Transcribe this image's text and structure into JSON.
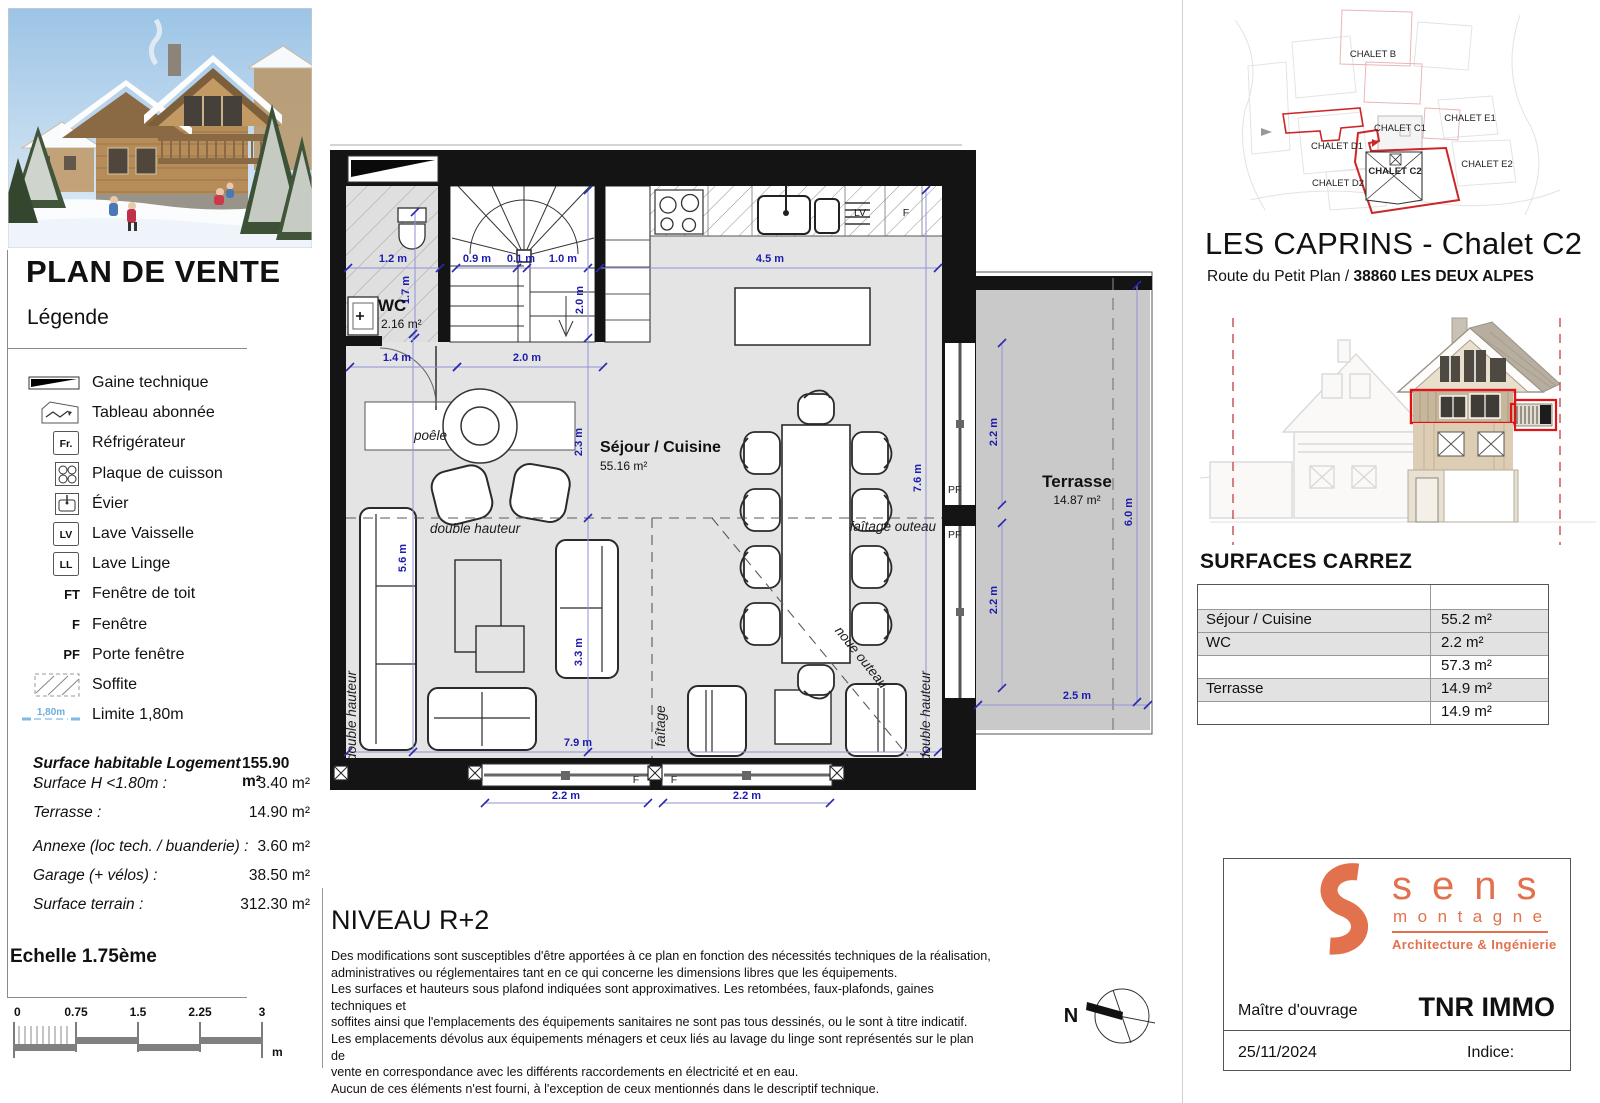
{
  "left_panel": {
    "title": "PLAN DE VENTE",
    "legend_title": "Légende",
    "legend_items": [
      {
        "type": "gaine",
        "label": "Gaine technique"
      },
      {
        "type": "tableau",
        "label": "Tableau abonnée"
      },
      {
        "type": "boxtext",
        "symbol": "Fr.",
        "label": "Réfrigérateur"
      },
      {
        "type": "plaque",
        "label": "Plaque de cuisson"
      },
      {
        "type": "evier",
        "label": "Évier"
      },
      {
        "type": "boxtext",
        "symbol": "LV",
        "label": "Lave Vaisselle"
      },
      {
        "type": "boxtext",
        "symbol": "LL",
        "label": "Lave Linge"
      },
      {
        "type": "text",
        "symbol": "FT",
        "label": "Fenêtre de toit"
      },
      {
        "type": "text",
        "symbol": "F",
        "label": "Fenêtre"
      },
      {
        "type": "text",
        "symbol": "PF",
        "label": "Porte fenêtre"
      },
      {
        "type": "soffite",
        "label": "Soffite"
      },
      {
        "type": "limite",
        "symbol": "1,80m",
        "label": "Limite 1,80m"
      }
    ],
    "surfaces": [
      {
        "label": "Surface habitable Logement :",
        "value": "155.90 m²",
        "bold": true,
        "top": 755
      },
      {
        "label": "Surface H <1.80m :",
        "value": "3.40 m²",
        "bold": false,
        "top": 775
      },
      {
        "label": "Terrasse :",
        "value": "14.90 m²",
        "bold": false,
        "top": 804
      },
      {
        "label": "Annexe (loc tech. / buanderie) :",
        "value": "3.60 m²",
        "bold": false,
        "top": 838
      },
      {
        "label": "Garage (+ vélos) :",
        "value": "38.50 m²",
        "bold": false,
        "top": 867
      },
      {
        "label": "Surface terrain :",
        "value": "312.30 m²",
        "bold": false,
        "top": 896
      }
    ],
    "scale_title": "Echelle 1.75ème",
    "scale_ticks": [
      "0",
      "0.75",
      "1.5",
      "2.25",
      "3"
    ],
    "scale_unit": "m"
  },
  "plan": {
    "level_title": "NIVEAU R+2",
    "disclaimer_lines": [
      "Des modifications sont susceptibles d'être apportées à ce plan en fonction des nécessités techniques de la réalisation,",
      "administratives ou réglementaires tant en ce qui concerne les dimensions libres que les équipements.",
      "Les surfaces et hauteurs sous plafond indiquées sont approximatives. Les retombées, faux-plafonds, gaines techniques et",
      "soffites ainsi que l'emplacements des équipements sanitaires ne sont pas tous dessinés, ou le sont à titre indicatif.",
      "Les emplacements dévolus aux équipements ménagers et ceux liés au lavage du linge sont représentés sur le plan de",
      "vente en correspondance avec les différents raccordements en électricité et en eau.",
      "Aucun de ces éléments n'est fourni, à l'exception de ceux mentionnés dans le descriptif technique."
    ],
    "compass_label": "N",
    "rooms": [
      {
        "name": "WC",
        "area": "2.16 m²",
        "nx": 378,
        "ny": 311,
        "ax": 381,
        "ay": 328,
        "ns": 17,
        "anchor": "start"
      },
      {
        "name": "Séjour / Cuisine",
        "area": "55.16 m²",
        "nx": 600,
        "ny": 452,
        "ax": 600,
        "ay": 470,
        "ns": 16,
        "anchor": "start"
      },
      {
        "name": "Terrasse",
        "area": "14.87 m²",
        "nx": 1077,
        "ny": 487,
        "ax": 1077,
        "ay": 504,
        "ns": 17,
        "anchor": "middle"
      }
    ],
    "dim_labels": [
      {
        "t": "1.2 m",
        "x": 393,
        "y": 262
      },
      {
        "t": "0.9 m",
        "x": 477,
        "y": 262
      },
      {
        "t": "0.1 m",
        "x": 521,
        "y": 262
      },
      {
        "t": "1.0 m",
        "x": 563,
        "y": 262
      },
      {
        "t": "4.5 m",
        "x": 770,
        "y": 262
      },
      {
        "t": "1.7 m",
        "x": 409,
        "y": 290,
        "r": -90
      },
      {
        "t": "2.0 m",
        "x": 583,
        "y": 300,
        "r": -90
      },
      {
        "t": "1.4 m",
        "x": 397,
        "y": 361
      },
      {
        "t": "2.0 m",
        "x": 527,
        "y": 361
      },
      {
        "t": "2.3 m",
        "x": 582,
        "y": 442,
        "r": -90
      },
      {
        "t": "3.3 m",
        "x": 582,
        "y": 652,
        "r": -90
      },
      {
        "t": "5.6 m",
        "x": 406,
        "y": 558,
        "r": -90
      },
      {
        "t": "7.6 m",
        "x": 921,
        "y": 478,
        "r": -90
      },
      {
        "t": "7.9 m",
        "x": 578,
        "y": 746
      },
      {
        "t": "2.2 m",
        "x": 566,
        "y": 799
      },
      {
        "t": "2.2 m",
        "x": 747,
        "y": 799
      },
      {
        "t": "2.2 m",
        "x": 997,
        "y": 432,
        "r": -90
      },
      {
        "t": "2.2 m",
        "x": 997,
        "y": 600,
        "r": -90
      },
      {
        "t": "6.0 m",
        "x": 1132,
        "y": 512,
        "r": -90
      },
      {
        "t": "2.5 m",
        "x": 1077,
        "y": 699
      }
    ],
    "annotations": [
      {
        "t": "poêle",
        "x": 447,
        "y": 440,
        "a": "end",
        "cls": "it"
      },
      {
        "t": "double hauteur",
        "x": 430,
        "y": 533,
        "a": "start",
        "cls": "it"
      },
      {
        "t": "double hauteur",
        "x": 356,
        "y": 716,
        "r": -90,
        "a": "middle",
        "cls": "it"
      },
      {
        "t": "double hauteur",
        "x": 930,
        "y": 716,
        "r": -90,
        "a": "middle",
        "cls": "it"
      },
      {
        "t": "faîtage",
        "x": 665,
        "y": 726,
        "r": -90,
        "a": "middle",
        "cls": "it"
      },
      {
        "t": "faîtage outeau",
        "x": 936,
        "y": 531,
        "a": "end",
        "cls": "it"
      },
      {
        "t": "noue outeau",
        "x": 858,
        "y": 660,
        "r": 51,
        "a": "middle",
        "cls": "it"
      },
      {
        "t": "LV",
        "x": 860,
        "y": 216,
        "a": "middle",
        "cls": "sm"
      },
      {
        "t": "F",
        "x": 906,
        "y": 216,
        "a": "middle",
        "cls": "sm"
      },
      {
        "t": "PF",
        "x": 948,
        "y": 493,
        "a": "start",
        "cls": "sm"
      },
      {
        "t": "PF",
        "x": 948,
        "y": 538,
        "a": "start",
        "cls": "sm"
      },
      {
        "t": "F",
        "x": 636,
        "y": 783,
        "a": "middle",
        "cls": "sm"
      },
      {
        "t": "F",
        "x": 674,
        "y": 783,
        "a": "middle",
        "cls": "sm"
      }
    ]
  },
  "site_plan": {
    "labels": [
      {
        "t": "CHALET B",
        "x": 1373,
        "y": 57,
        "bold": false
      },
      {
        "t": "CHALET C1",
        "x": 1400,
        "y": 131,
        "bold": false
      },
      {
        "t": "CHALET E1",
        "x": 1470,
        "y": 121,
        "bold": false
      },
      {
        "t": "CHALET D1",
        "x": 1337,
        "y": 149,
        "bold": false
      },
      {
        "t": "CHALET C2",
        "x": 1395,
        "y": 174,
        "bold": true
      },
      {
        "t": "CHALET E2",
        "x": 1487,
        "y": 167,
        "bold": false
      },
      {
        "t": "CHALET D2",
        "x": 1338,
        "y": 186,
        "bold": false
      }
    ]
  },
  "header": {
    "title": "LES CAPRINS - Chalet C2",
    "address_regular": "Route du Petit Plan / ",
    "address_bold": "38860 LES DEUX ALPES"
  },
  "surfaces_carrez": {
    "heading": "SURFACES CARREZ",
    "rows": [
      {
        "label": "",
        "value": "",
        "shaded": false
      },
      {
        "label": "Séjour / Cuisine",
        "value": "55.2 m²",
        "shaded": true
      },
      {
        "label": "WC",
        "value": "2.2 m²",
        "shaded": true
      },
      {
        "label": "",
        "value": "57.3 m²",
        "shaded": false
      },
      {
        "label": "Terrasse",
        "value": "14.9 m²",
        "shaded": true
      },
      {
        "label": "",
        "value": "14.9 m²",
        "shaded": false
      }
    ]
  },
  "title_block": {
    "logo_word1": "sens",
    "logo_word2": "montagne",
    "logo_tagline": "Architecture & Ingénierie",
    "owner_label": "Maître d'ouvrage",
    "owner_name": "TNR IMMO",
    "date": "25/11/2024",
    "indice_label": "Indice:"
  },
  "colors": {
    "accent_orange": "#e2714e",
    "dim_blue": "#1c1cae",
    "limit_blue": "#7fb9e6",
    "red_outline": "#cc2626"
  }
}
